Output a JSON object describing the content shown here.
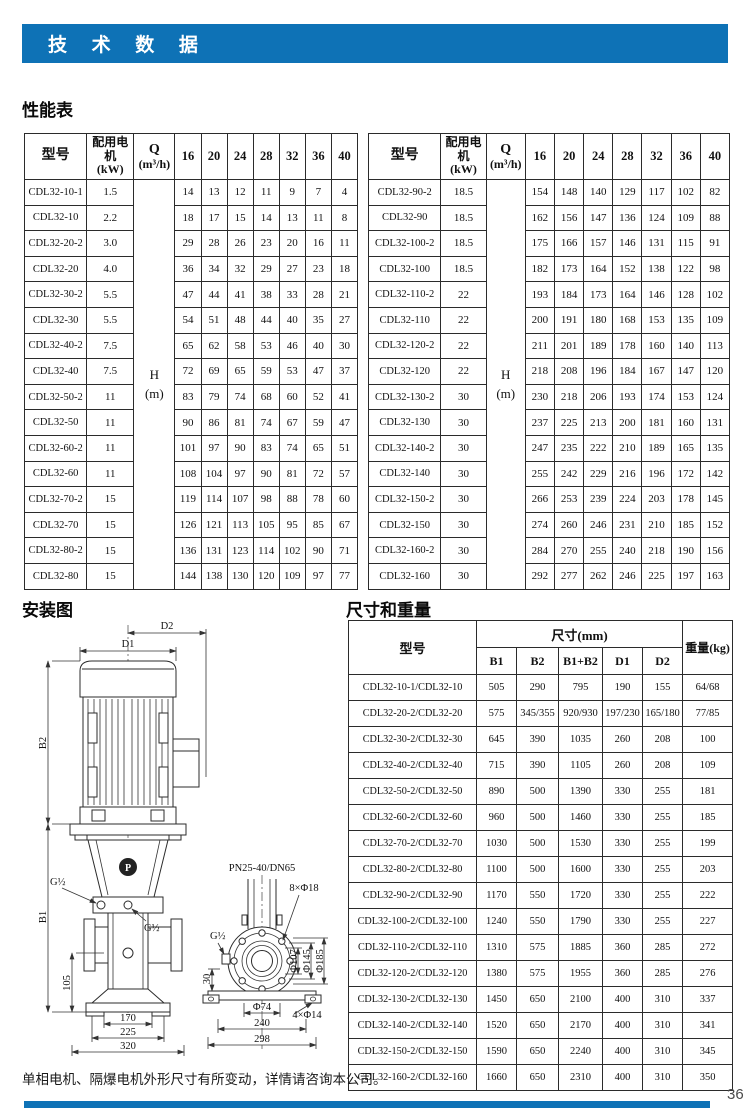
{
  "page": {
    "title": "技 术 数 据",
    "accent_color": "#0e72b6",
    "note": "单相电机、隔爆电机外形尺寸有所变动，详情请咨询本公司。",
    "page_number": "36"
  },
  "performance": {
    "heading": "性能表",
    "columns": {
      "model": "型号",
      "motor_line1": "配用电机",
      "motor_line2": "(kW)",
      "q_line1": "Q",
      "q_line2": "(m³/h)",
      "flows": [
        "16",
        "20",
        "24",
        "28",
        "32",
        "36",
        "40"
      ],
      "head_label": "H",
      "head_unit": "(m)"
    },
    "left_rows": [
      {
        "model": "CDL32-10-1",
        "kw": "1.5",
        "h": [
          14,
          13,
          12,
          11,
          9,
          7,
          4
        ]
      },
      {
        "model": "CDL32-10",
        "kw": "2.2",
        "h": [
          18,
          17,
          15,
          14,
          13,
          11,
          8
        ]
      },
      {
        "model": "CDL32-20-2",
        "kw": "3.0",
        "h": [
          29,
          28,
          26,
          23,
          20,
          16,
          11
        ]
      },
      {
        "model": "CDL32-20",
        "kw": "4.0",
        "h": [
          36,
          34,
          32,
          29,
          27,
          23,
          18
        ]
      },
      {
        "model": "CDL32-30-2",
        "kw": "5.5",
        "h": [
          47,
          44,
          41,
          38,
          33,
          28,
          21
        ]
      },
      {
        "model": "CDL32-30",
        "kw": "5.5",
        "h": [
          54,
          51,
          48,
          44,
          40,
          35,
          27
        ]
      },
      {
        "model": "CDL32-40-2",
        "kw": "7.5",
        "h": [
          65,
          62,
          58,
          53,
          46,
          40,
          30
        ]
      },
      {
        "model": "CDL32-40",
        "kw": "7.5",
        "h": [
          72,
          69,
          65,
          59,
          53,
          47,
          37
        ]
      },
      {
        "model": "CDL32-50-2",
        "kw": "11",
        "h": [
          83,
          79,
          74,
          68,
          60,
          52,
          41
        ]
      },
      {
        "model": "CDL32-50",
        "kw": "11",
        "h": [
          90,
          86,
          81,
          74,
          67,
          59,
          47
        ]
      },
      {
        "model": "CDL32-60-2",
        "kw": "11",
        "h": [
          101,
          97,
          90,
          83,
          74,
          65,
          51
        ]
      },
      {
        "model": "CDL32-60",
        "kw": "11",
        "h": [
          108,
          104,
          97,
          90,
          81,
          72,
          57
        ]
      },
      {
        "model": "CDL32-70-2",
        "kw": "15",
        "h": [
          119,
          114,
          107,
          98,
          88,
          78,
          60
        ]
      },
      {
        "model": "CDL32-70",
        "kw": "15",
        "h": [
          126,
          121,
          113,
          105,
          95,
          85,
          67
        ]
      },
      {
        "model": "CDL32-80-2",
        "kw": "15",
        "h": [
          136,
          131,
          123,
          114,
          102,
          90,
          71
        ]
      },
      {
        "model": "CDL32-80",
        "kw": "15",
        "h": [
          144,
          138,
          130,
          120,
          109,
          97,
          77
        ]
      }
    ],
    "right_rows": [
      {
        "model": "CDL32-90-2",
        "kw": "18.5",
        "h": [
          154,
          148,
          140,
          129,
          117,
          102,
          82
        ]
      },
      {
        "model": "CDL32-90",
        "kw": "18.5",
        "h": [
          162,
          156,
          147,
          136,
          124,
          109,
          88
        ]
      },
      {
        "model": "CDL32-100-2",
        "kw": "18.5",
        "h": [
          175,
          166,
          157,
          146,
          131,
          115,
          91
        ]
      },
      {
        "model": "CDL32-100",
        "kw": "18.5",
        "h": [
          182,
          173,
          164,
          152,
          138,
          122,
          98
        ]
      },
      {
        "model": "CDL32-110-2",
        "kw": "22",
        "h": [
          193,
          184,
          173,
          164,
          146,
          128,
          102
        ]
      },
      {
        "model": "CDL32-110",
        "kw": "22",
        "h": [
          200,
          191,
          180,
          168,
          153,
          135,
          109
        ]
      },
      {
        "model": "CDL32-120-2",
        "kw": "22",
        "h": [
          211,
          201,
          189,
          178,
          160,
          140,
          113
        ]
      },
      {
        "model": "CDL32-120",
        "kw": "22",
        "h": [
          218,
          208,
          196,
          184,
          167,
          147,
          120
        ]
      },
      {
        "model": "CDL32-130-2",
        "kw": "30",
        "h": [
          230,
          218,
          206,
          193,
          174,
          153,
          124
        ]
      },
      {
        "model": "CDL32-130",
        "kw": "30",
        "h": [
          237,
          225,
          213,
          200,
          181,
          160,
          131
        ]
      },
      {
        "model": "CDL32-140-2",
        "kw": "30",
        "h": [
          247,
          235,
          222,
          210,
          189,
          165,
          135
        ]
      },
      {
        "model": "CDL32-140",
        "kw": "30",
        "h": [
          255,
          242,
          229,
          216,
          196,
          172,
          142
        ]
      },
      {
        "model": "CDL32-150-2",
        "kw": "30",
        "h": [
          266,
          253,
          239,
          224,
          203,
          178,
          145
        ]
      },
      {
        "model": "CDL32-150",
        "kw": "30",
        "h": [
          274,
          260,
          246,
          231,
          210,
          185,
          152
        ]
      },
      {
        "model": "CDL32-160-2",
        "kw": "30",
        "h": [
          284,
          270,
          255,
          240,
          218,
          190,
          156
        ]
      },
      {
        "model": "CDL32-160",
        "kw": "30",
        "h": [
          292,
          277,
          262,
          246,
          225,
          197,
          163
        ]
      }
    ]
  },
  "installation": {
    "heading": "安装图",
    "labels": {
      "d1": "D1",
      "d2": "D2",
      "b1": "B1",
      "b2": "B2",
      "g_half": "G½",
      "dim_105": "105",
      "dim_170": "170",
      "dim_225": "225",
      "dim_320": "320",
      "flange_spec": "PN25-40/DN65",
      "bolt_top": "8×Φ18",
      "bolt_bottom": "4×Φ14",
      "phi_107": "Φ107",
      "phi_145": "Φ145",
      "phi_185": "Φ185",
      "phi_74": "Φ74",
      "dim_30": "30",
      "dim_240": "240",
      "dim_298": "298",
      "logo": "P"
    }
  },
  "dimensions": {
    "heading": "尺寸和重量",
    "columns": {
      "model": "型号",
      "size_group": "尺寸(mm)",
      "b1": "B1",
      "b2": "B2",
      "b1b2": "B1+B2",
      "d1": "D1",
      "d2": "D2",
      "weight": "重量(kg)"
    },
    "rows": [
      {
        "model": "CDL32-10-1/CDL32-10",
        "b1": "505",
        "b2": "290",
        "b1b2": "795",
        "d1": "190",
        "d2": "155",
        "weight": "64/68"
      },
      {
        "model": "CDL32-20-2/CDL32-20",
        "b1": "575",
        "b2": "345/355",
        "b1b2": "920/930",
        "d1": "197/230",
        "d2": "165/180",
        "weight": "77/85"
      },
      {
        "model": "CDL32-30-2/CDL32-30",
        "b1": "645",
        "b2": "390",
        "b1b2": "1035",
        "d1": "260",
        "d2": "208",
        "weight": "100"
      },
      {
        "model": "CDL32-40-2/CDL32-40",
        "b1": "715",
        "b2": "390",
        "b1b2": "1105",
        "d1": "260",
        "d2": "208",
        "weight": "109"
      },
      {
        "model": "CDL32-50-2/CDL32-50",
        "b1": "890",
        "b2": "500",
        "b1b2": "1390",
        "d1": "330",
        "d2": "255",
        "weight": "181"
      },
      {
        "model": "CDL32-60-2/CDL32-60",
        "b1": "960",
        "b2": "500",
        "b1b2": "1460",
        "d1": "330",
        "d2": "255",
        "weight": "185"
      },
      {
        "model": "CDL32-70-2/CDL32-70",
        "b1": "1030",
        "b2": "500",
        "b1b2": "1530",
        "d1": "330",
        "d2": "255",
        "weight": "199"
      },
      {
        "model": "CDL32-80-2/CDL32-80",
        "b1": "1100",
        "b2": "500",
        "b1b2": "1600",
        "d1": "330",
        "d2": "255",
        "weight": "203"
      },
      {
        "model": "CDL32-90-2/CDL32-90",
        "b1": "1170",
        "b2": "550",
        "b1b2": "1720",
        "d1": "330",
        "d2": "255",
        "weight": "222"
      },
      {
        "model": "CDL32-100-2/CDL32-100",
        "b1": "1240",
        "b2": "550",
        "b1b2": "1790",
        "d1": "330",
        "d2": "255",
        "weight": "227"
      },
      {
        "model": "CDL32-110-2/CDL32-110",
        "b1": "1310",
        "b2": "575",
        "b1b2": "1885",
        "d1": "360",
        "d2": "285",
        "weight": "272"
      },
      {
        "model": "CDL32-120-2/CDL32-120",
        "b1": "1380",
        "b2": "575",
        "b1b2": "1955",
        "d1": "360",
        "d2": "285",
        "weight": "276"
      },
      {
        "model": "CDL32-130-2/CDL32-130",
        "b1": "1450",
        "b2": "650",
        "b1b2": "2100",
        "d1": "400",
        "d2": "310",
        "weight": "337"
      },
      {
        "model": "CDL32-140-2/CDL32-140",
        "b1": "1520",
        "b2": "650",
        "b1b2": "2170",
        "d1": "400",
        "d2": "310",
        "weight": "341"
      },
      {
        "model": "CDL32-150-2/CDL32-150",
        "b1": "1590",
        "b2": "650",
        "b1b2": "2240",
        "d1": "400",
        "d2": "310",
        "weight": "345"
      },
      {
        "model": "CDL32-160-2/CDL32-160",
        "b1": "1660",
        "b2": "650",
        "b1b2": "2310",
        "d1": "400",
        "d2": "310",
        "weight": "350"
      }
    ]
  }
}
